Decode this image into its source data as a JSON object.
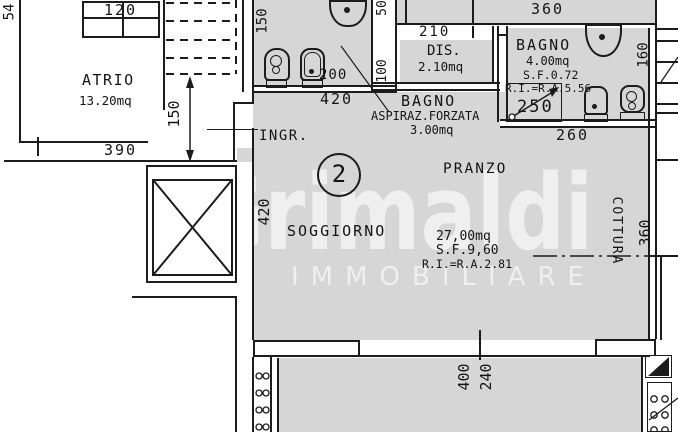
{
  "plan": {
    "unit_number": "2",
    "watermark": {
      "name": "Grimaldi",
      "subtitle": "IMMOBILIARE"
    },
    "rooms": {
      "atrio": {
        "name": "ATRIO",
        "area": "13.20mq"
      },
      "ingresso": {
        "name": "INGR."
      },
      "soggiorno": {
        "name": "SOGGIORNO",
        "area": "27,00mq",
        "sf": "S.F.9,60",
        "ri": "R.I.=R.A.2.81"
      },
      "pranzo": {
        "name": "PRANZO"
      },
      "cottura": {
        "name": "COTTURA"
      },
      "dis": {
        "name": "DIS.",
        "area": "2.10mq"
      },
      "bagno_vent": {
        "name": "BAGNO",
        "note": "ASPIRAZ.FORZATA",
        "area": "3.00mq"
      },
      "bagno": {
        "name": "BAGNO",
        "area": "4.00mq",
        "sf": "S.F.0.72",
        "ri": "R.I.=R.A.5.56"
      }
    },
    "dims": {
      "d54": "54",
      "d120": "120",
      "d150_scala": "150",
      "d390": "390",
      "d150_bagno": "150",
      "d420_bagno": "420",
      "d200": "200",
      "d50": "50",
      "d100": "100",
      "d210": "210",
      "d360_alto": "360",
      "d250": "250",
      "d160": "160",
      "d260": "260",
      "d420_sogg": "420",
      "d360_dx": "360",
      "d400": "400",
      "d240": "240"
    }
  }
}
